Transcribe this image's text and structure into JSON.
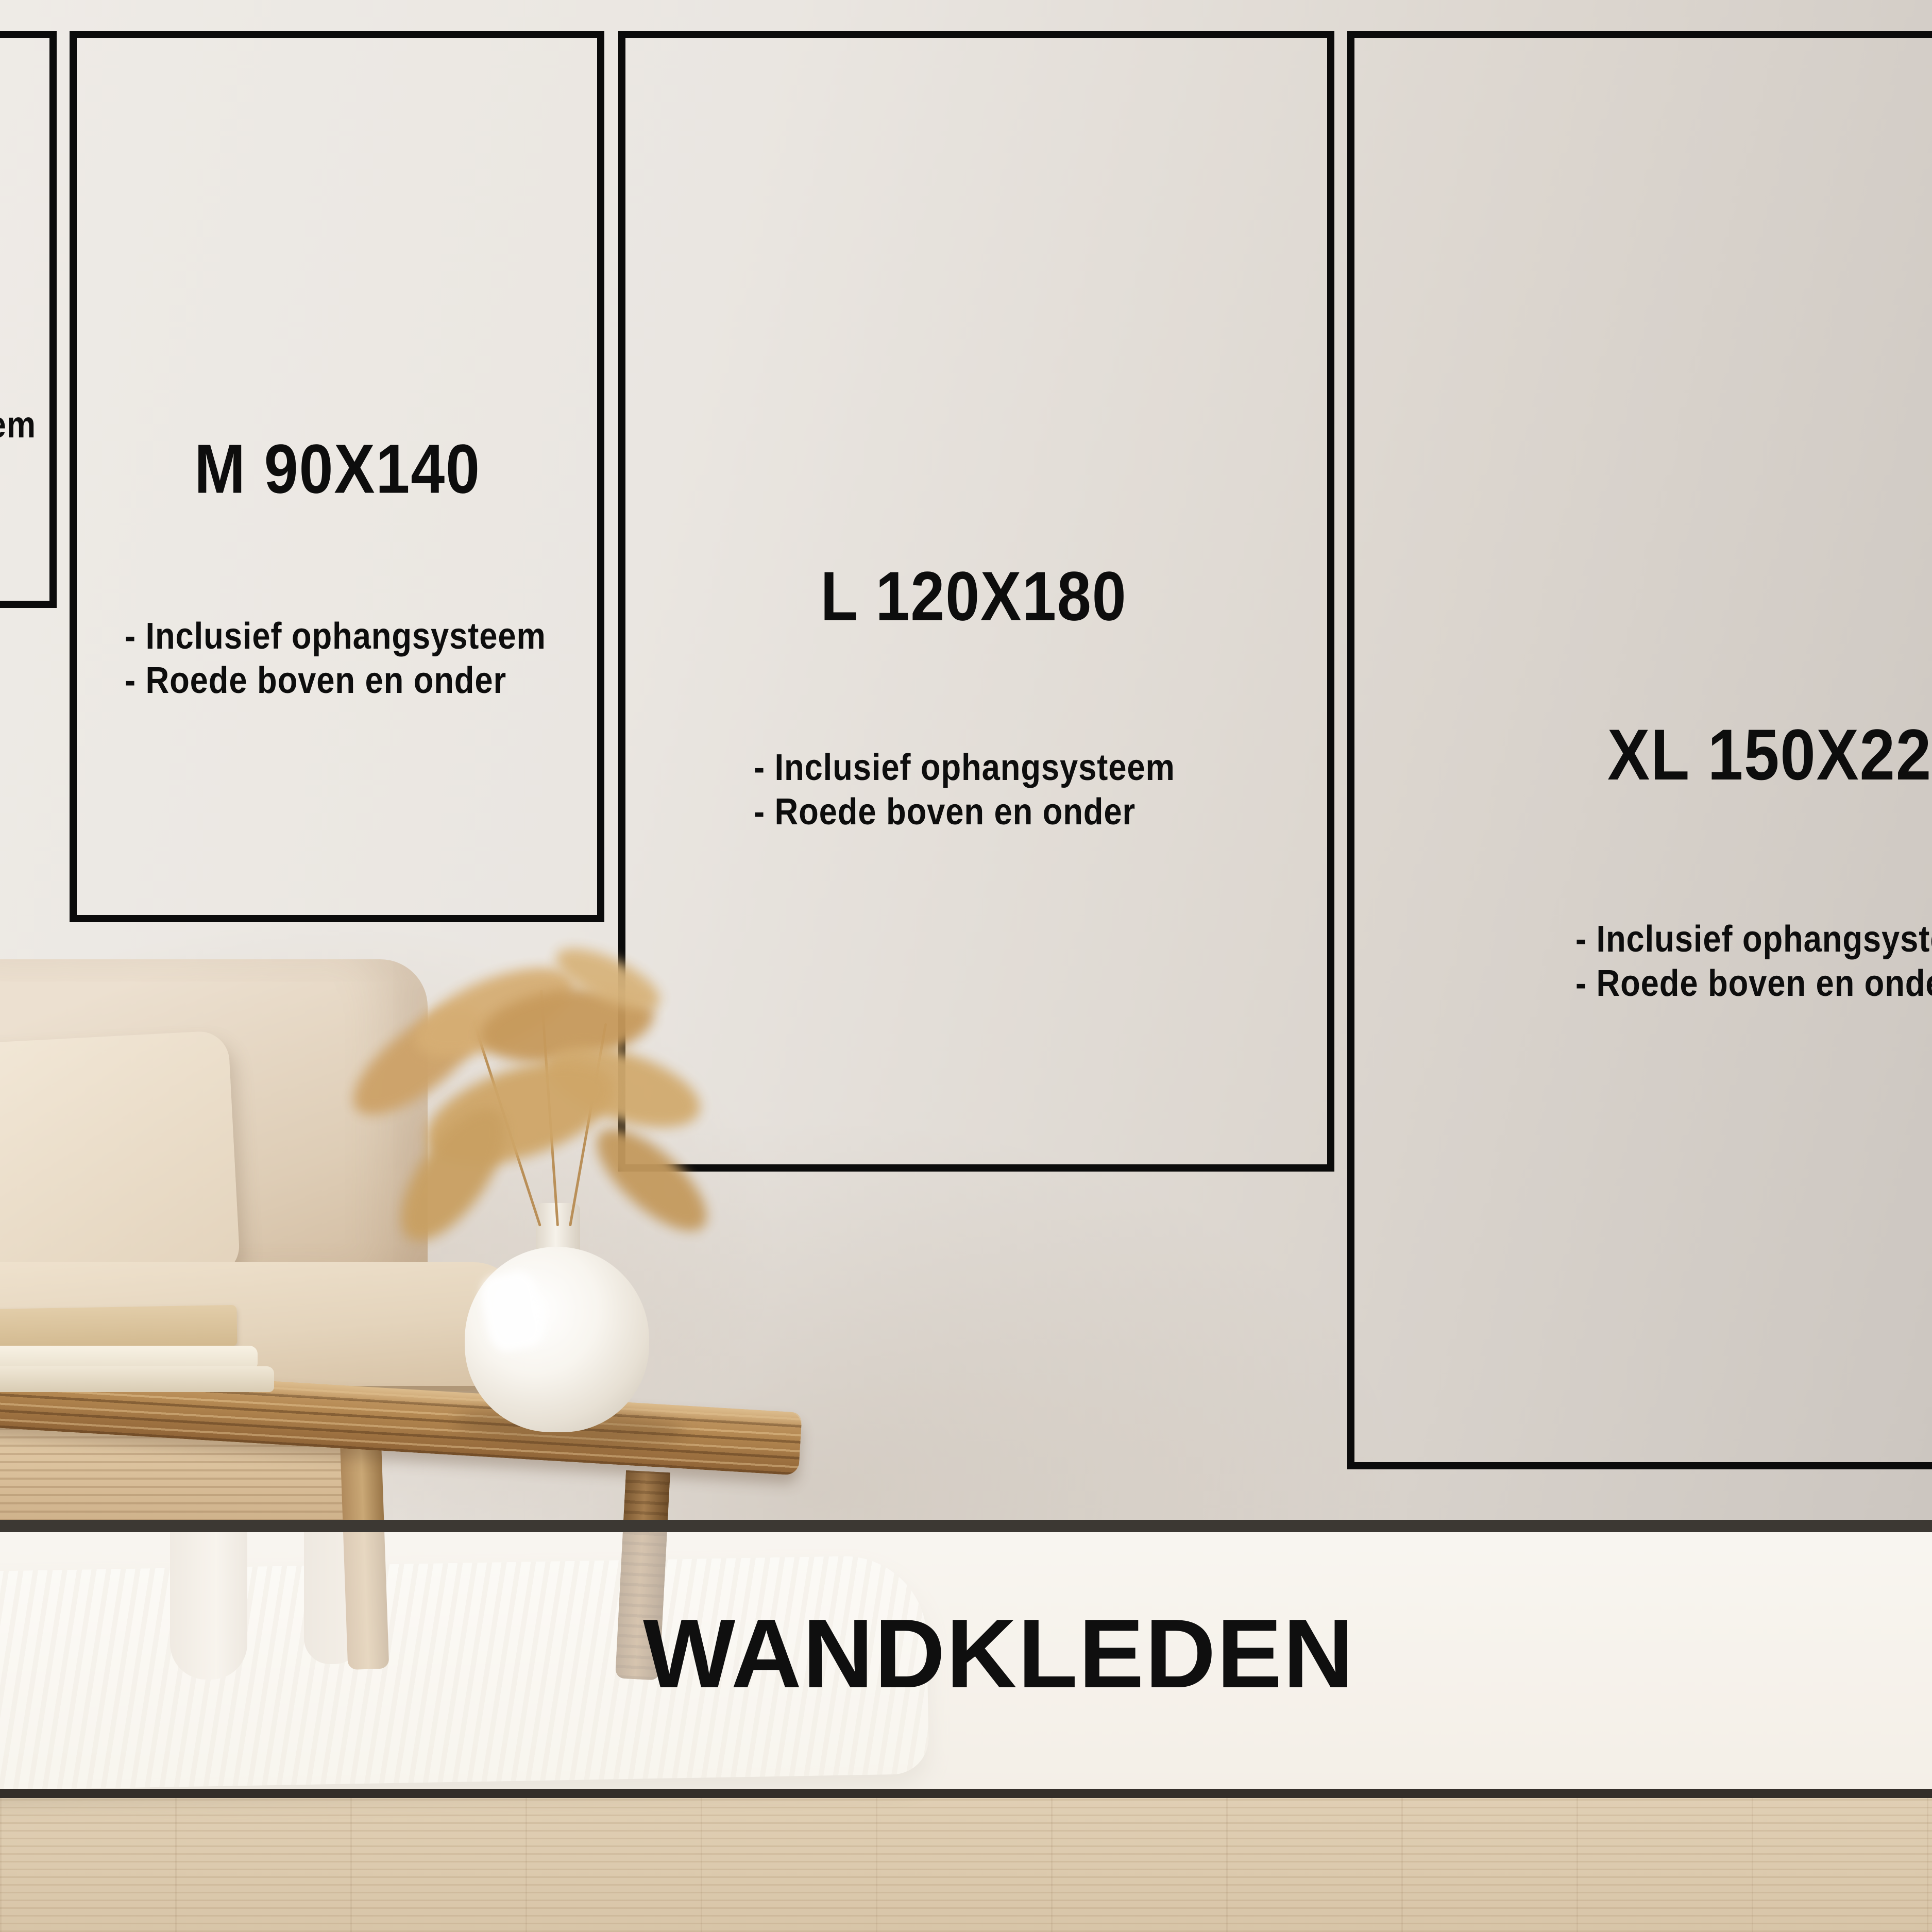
{
  "banner": {
    "label": "WANDKLEDEN"
  },
  "size_cards": [
    {
      "key": "s-partial",
      "title": "",
      "bullets": [
        "- Inclusief ophangsysteem"
      ]
    },
    {
      "key": "m",
      "title": "M 90X140",
      "bullets": [
        "- Inclusief ophangsysteem",
        "- Roede boven en onder"
      ]
    },
    {
      "key": "l",
      "title": "L 120X180",
      "bullets": [
        "- Inclusief ophangsysteem",
        "- Roede boven en onder"
      ]
    },
    {
      "key": "xl",
      "title": "XL 150X220",
      "bullets": [
        "- Inclusief ophangsysteem",
        "- Roede boven en onder"
      ]
    }
  ],
  "colors": {
    "card_border": "#0b0b0b",
    "card_text": "#0d0d0d",
    "banner_text": "#0f0f0f",
    "band_line": "#3c3833",
    "wall": "#e7e2dc",
    "wood_floor": "#d8c5a8"
  }
}
